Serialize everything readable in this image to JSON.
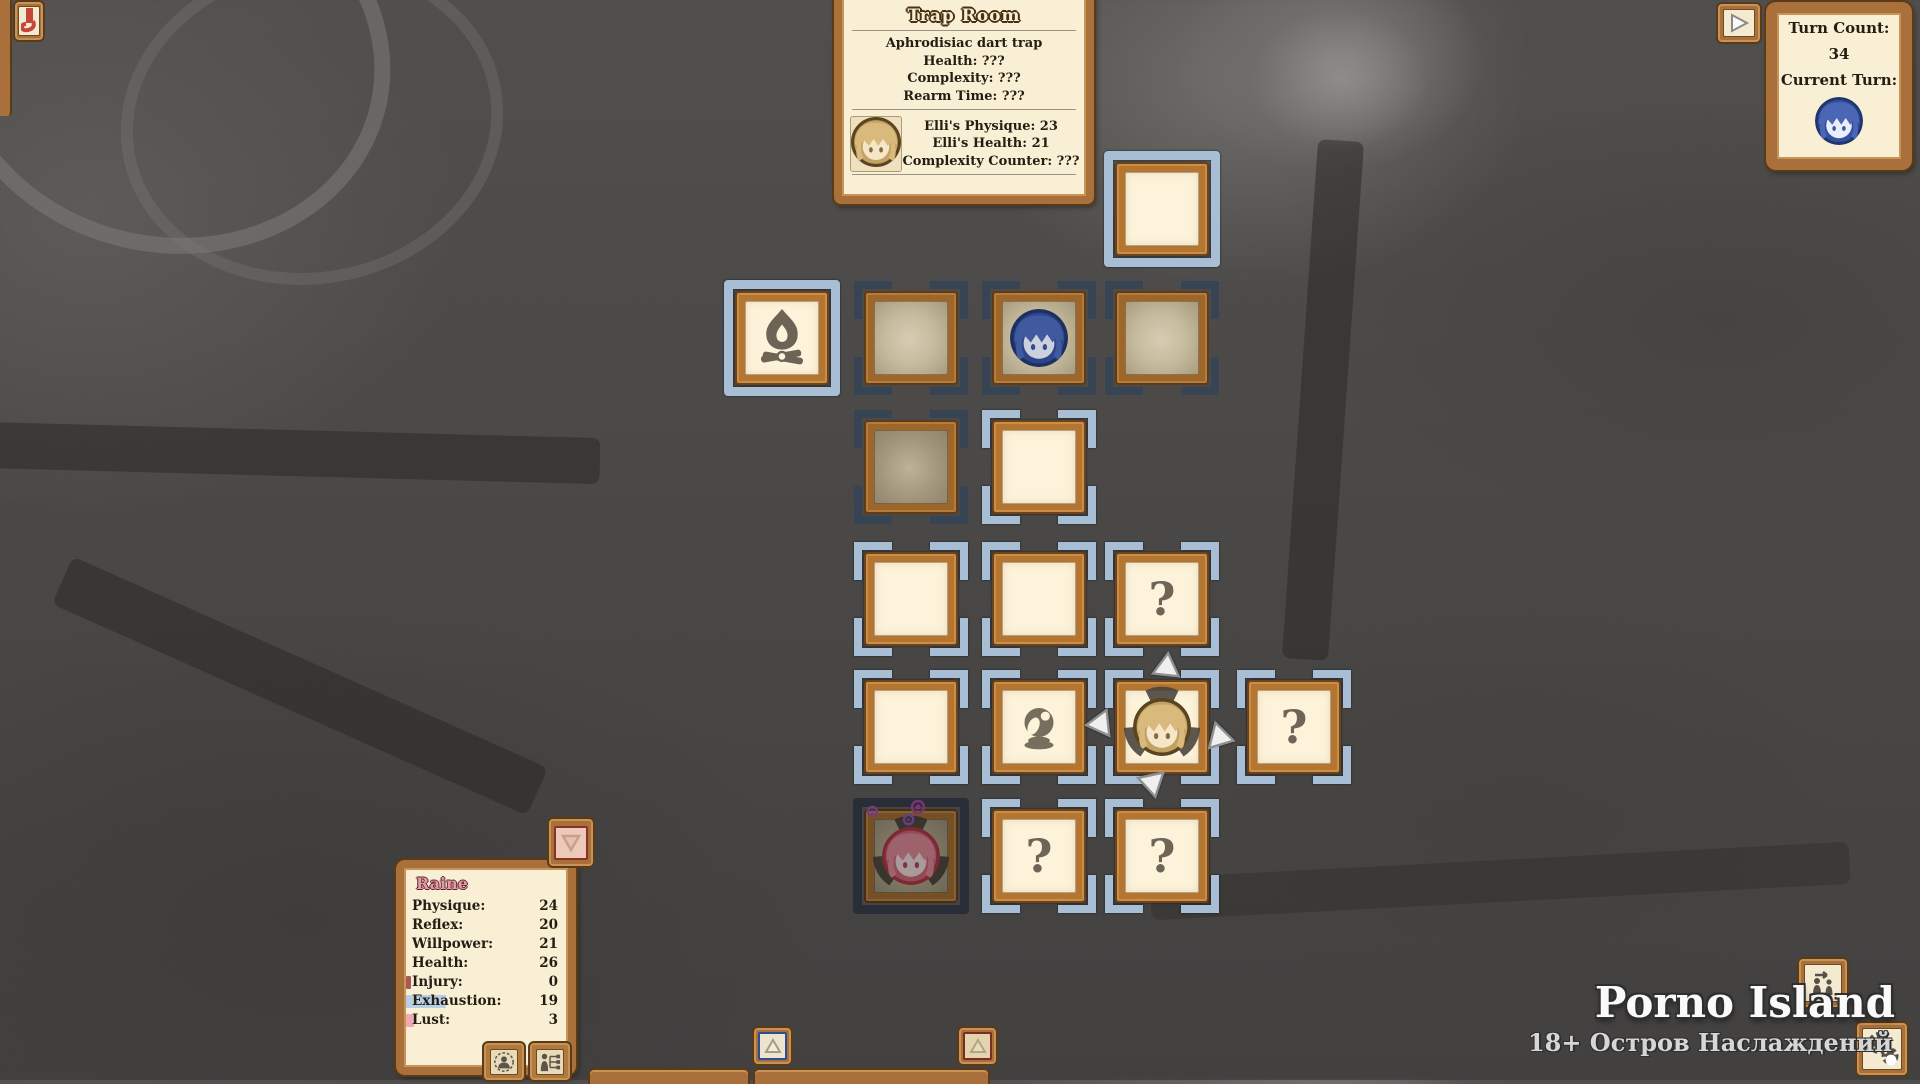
{
  "game": {
    "title": "Porno Island",
    "subtitle": "18+ Остров Наслаждений"
  },
  "colors": {
    "panel_cream": "#f8efd5",
    "panel_brown": "#a9703b",
    "bracket_light": "#a7bed4",
    "bracket_dark": "#3e4d60",
    "icon_grey": "#6e6557",
    "accent_red": "#c7463a"
  },
  "trap_panel": {
    "title": "Trap Room",
    "lines": [
      "Aphrodisiac dart trap",
      "Health: ???",
      "Complexity: ???",
      "Rearm Time: ???"
    ],
    "portrait": "blonde",
    "lower_lines": [
      "Elli's Physique: 23",
      "Elli's Health: 21",
      "Complexity Counter: ???"
    ]
  },
  "turn_panel": {
    "turn_count_label": "Turn Count:",
    "turn_count": "34",
    "current_turn_label": "Current Turn:",
    "current_turn_portrait": "blue"
  },
  "character_panel": {
    "name": "Raine",
    "stats": [
      {
        "label": "Physique:",
        "value": "24",
        "bar_color": null,
        "bar_width": 0
      },
      {
        "label": "Reflex:",
        "value": "20",
        "bar_color": null,
        "bar_width": 0
      },
      {
        "label": "Willpower:",
        "value": "21",
        "bar_color": null,
        "bar_width": 0
      },
      {
        "label": "Health:",
        "value": "26",
        "bar_color": null,
        "bar_width": 0
      },
      {
        "label": "Injury:",
        "value": "0",
        "bar_color": "#a85a50",
        "bar_width": 5
      },
      {
        "label": "Exhaustion:",
        "value": "19",
        "bar_color": "#b9cfe6",
        "bar_width": 40
      },
      {
        "label": "Lust:",
        "value": "3",
        "bar_color": "#f0aab6",
        "bar_width": 8
      }
    ],
    "buttons": [
      {
        "icon": "portrait-circle-icon"
      },
      {
        "icon": "skill-tree-icon"
      }
    ]
  },
  "map": {
    "question_glyph": "?",
    "tiles": [
      {
        "row": 1,
        "col": 4,
        "border": "full",
        "tone": "light",
        "bg": "cream",
        "icon": null,
        "arrows": false,
        "fan": false,
        "sparkles": false,
        "dim": "none"
      },
      {
        "row": 2,
        "col": 1,
        "border": "full",
        "tone": "light",
        "bg": "cream",
        "icon": "fire",
        "arrows": false,
        "fan": false,
        "sparkles": false,
        "dim": "none"
      },
      {
        "row": 2,
        "col": 2,
        "border": "corners",
        "tone": "dark",
        "bg": "glow",
        "icon": null,
        "arrows": false,
        "fan": false,
        "sparkles": false,
        "dim": "half"
      },
      {
        "row": 2,
        "col": 3,
        "border": "corners",
        "tone": "dark",
        "bg": "glow",
        "icon": "portrait-blue",
        "arrows": false,
        "fan": false,
        "sparkles": false,
        "dim": "half"
      },
      {
        "row": 2,
        "col": 4,
        "border": "corners",
        "tone": "dark",
        "bg": "glow",
        "icon": null,
        "arrows": false,
        "fan": false,
        "sparkles": false,
        "dim": "half"
      },
      {
        "row": 3,
        "col": 2,
        "border": "corners",
        "tone": "dark",
        "bg": "glow-dim",
        "icon": null,
        "arrows": false,
        "fan": false,
        "sparkles": false,
        "dim": "half"
      },
      {
        "row": 3,
        "col": 3,
        "border": "corners",
        "tone": "light",
        "bg": "cream",
        "icon": null,
        "arrows": false,
        "fan": false,
        "sparkles": false,
        "dim": "none"
      },
      {
        "row": 4,
        "col": 2,
        "border": "corners",
        "tone": "light",
        "bg": "cream",
        "icon": null,
        "arrows": false,
        "fan": false,
        "sparkles": false,
        "dim": "none"
      },
      {
        "row": 4,
        "col": 3,
        "border": "corners",
        "tone": "light",
        "bg": "cream",
        "icon": null,
        "arrows": false,
        "fan": false,
        "sparkles": false,
        "dim": "none"
      },
      {
        "row": 4,
        "col": 4,
        "border": "corners",
        "tone": "light",
        "bg": "cream",
        "icon": "question",
        "arrows": false,
        "fan": false,
        "sparkles": false,
        "dim": "none"
      },
      {
        "row": 5,
        "col": 2,
        "border": "corners",
        "tone": "light",
        "bg": "cream",
        "icon": null,
        "arrows": false,
        "fan": false,
        "sparkles": false,
        "dim": "none"
      },
      {
        "row": 5,
        "col": 3,
        "border": "corners",
        "tone": "light",
        "bg": "cream",
        "icon": "orb",
        "arrows": false,
        "fan": false,
        "sparkles": false,
        "dim": "none"
      },
      {
        "row": 5,
        "col": 4,
        "border": "corners",
        "tone": "light",
        "bg": "cream",
        "icon": "portrait-blonde",
        "arrows": true,
        "fan": true,
        "sparkles": false,
        "dim": "none"
      },
      {
        "row": 5,
        "col": 5,
        "border": "corners",
        "tone": "light",
        "bg": "cream",
        "icon": "question",
        "arrows": false,
        "fan": false,
        "sparkles": false,
        "dim": "none"
      },
      {
        "row": 6,
        "col": 2,
        "border": "full",
        "tone": "dark",
        "bg": "glow-dim",
        "icon": "portrait-pink",
        "arrows": false,
        "fan": true,
        "sparkles": true,
        "dim": "full"
      },
      {
        "row": 6,
        "col": 3,
        "border": "corners",
        "tone": "light",
        "bg": "cream",
        "icon": "question",
        "arrows": false,
        "fan": false,
        "sparkles": false,
        "dim": "none"
      },
      {
        "row": 6,
        "col": 4,
        "border": "corners",
        "tone": "light",
        "bg": "cream",
        "icon": "question",
        "arrows": false,
        "fan": false,
        "sparkles": false,
        "dim": "none"
      }
    ]
  },
  "hud": {
    "alert_banner": "alert-banner",
    "play_next": "play-next",
    "scroll_up_blue": "scroll-up-blue",
    "scroll_up_red": "scroll-up-red",
    "collapse_down": "collapse-down",
    "swap_characters": "swap-characters",
    "settings": "settings"
  }
}
